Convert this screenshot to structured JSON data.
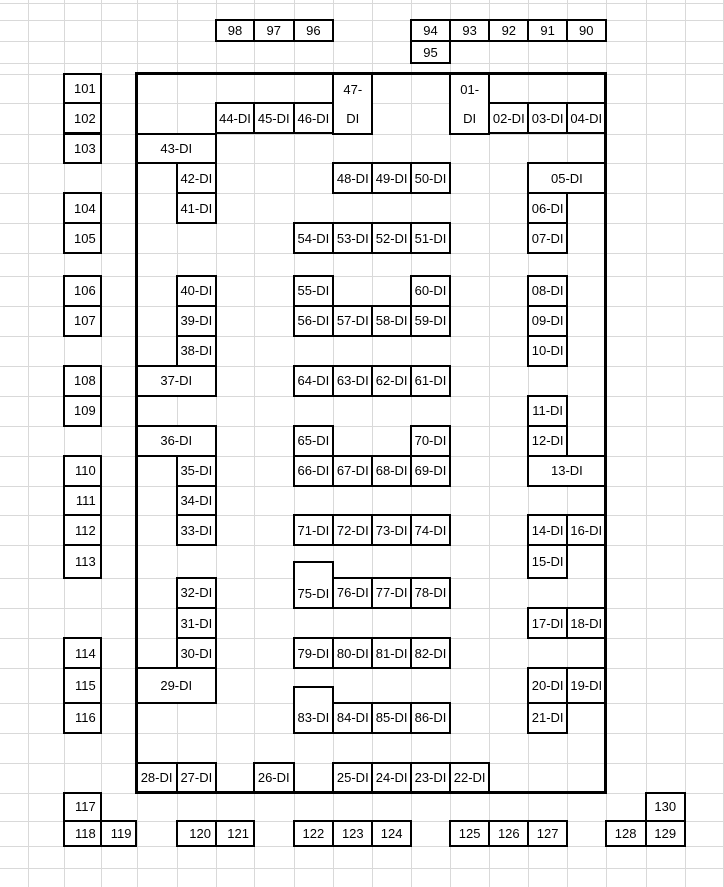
{
  "sheet": {
    "background": "#ffffff",
    "gridline_color": "#d9d9d9",
    "cell_border_color": "#000000",
    "outline_border_color": "#000000",
    "text_color": "#000000",
    "col_lines": [
      28,
      64,
      100.7,
      136.5,
      176.7,
      216,
      254,
      293.5,
      333.3,
      372.3,
      411,
      450,
      489.3,
      528.3,
      567,
      605.5,
      645.8,
      684.7,
      723.3
    ],
    "row_lines": [
      3,
      20.3,
      41,
      63,
      73.5,
      103.3,
      133.5,
      163.3,
      193,
      223.3,
      253.3,
      275.7,
      305.7,
      335.7,
      365.7,
      395.7,
      425.7,
      455.7,
      485.7,
      515.3,
      545.3,
      577.7,
      608,
      638,
      668,
      702.5,
      732.5,
      762.5,
      792.5,
      821,
      846,
      868
    ],
    "outline": {
      "x1": 136.5,
      "y1": 73.5,
      "x2": 605.5,
      "y2": 792.5
    },
    "cells": [
      [
        "98",
        216,
        20.3,
        254,
        41,
        "c"
      ],
      [
        "97",
        254,
        20.3,
        293.5,
        41,
        "c"
      ],
      [
        "96",
        293.5,
        20.3,
        333.3,
        41,
        "c"
      ],
      [
        "94",
        411,
        20.3,
        450,
        41,
        "c"
      ],
      [
        "93",
        450,
        20.3,
        489.3,
        41,
        "c"
      ],
      [
        "92",
        489.3,
        20.3,
        528.3,
        41,
        "c"
      ],
      [
        "91",
        528.3,
        20.3,
        567,
        41,
        "c"
      ],
      [
        "90",
        567,
        20.3,
        605.5,
        41,
        "c"
      ],
      [
        "95",
        411,
        41,
        450,
        63,
        "c"
      ],
      [
        "101",
        64,
        73.5,
        100.7,
        103.3,
        "r"
      ],
      [
        "102",
        64,
        103.3,
        100.7,
        133.5,
        "r"
      ],
      [
        "103",
        64,
        133.5,
        100.7,
        163.3,
        "r"
      ],
      [
        "104",
        64,
        193,
        100.7,
        223.3,
        "r"
      ],
      [
        "105",
        64,
        223.3,
        100.7,
        253.3,
        "r"
      ],
      [
        "106",
        64,
        275.7,
        100.7,
        305.7,
        "r"
      ],
      [
        "107",
        64,
        305.7,
        100.7,
        335.7,
        "r"
      ],
      [
        "108",
        64,
        365.7,
        100.7,
        395.7,
        "r"
      ],
      [
        "109",
        64,
        395.7,
        100.7,
        425.7,
        "r"
      ],
      [
        "110",
        64,
        455.7,
        100.7,
        485.7,
        "r"
      ],
      [
        "111",
        64,
        485.7,
        100.7,
        515.3,
        "r"
      ],
      [
        "112",
        64,
        515.3,
        100.7,
        545.3,
        "r"
      ],
      [
        "113",
        64,
        545.3,
        100.7,
        577.7,
        "r"
      ],
      [
        "114",
        64,
        638,
        100.7,
        668,
        "r"
      ],
      [
        "115",
        64,
        668,
        100.7,
        702.5,
        "r"
      ],
      [
        "116",
        64,
        702.5,
        100.7,
        732.5,
        "r"
      ],
      [
        "117",
        64,
        792.5,
        100.7,
        821,
        "r"
      ],
      [
        "118",
        64,
        821,
        100.7,
        846,
        "r"
      ],
      [
        "119",
        100.7,
        821,
        136.5,
        846,
        "r"
      ],
      [
        "120",
        176.7,
        821,
        216,
        846,
        "r"
      ],
      [
        "121",
        216,
        821,
        254,
        846,
        "r"
      ],
      [
        "122",
        293.5,
        821,
        333.3,
        846,
        "c"
      ],
      [
        "123",
        333.3,
        821,
        372.3,
        846,
        "c"
      ],
      [
        "124",
        372.3,
        821,
        411,
        846,
        "c"
      ],
      [
        "125",
        450,
        821,
        489.3,
        846,
        "c"
      ],
      [
        "126",
        489.3,
        821,
        528.3,
        846,
        "c"
      ],
      [
        "127",
        528.3,
        821,
        567,
        846,
        "c"
      ],
      [
        "128",
        605.5,
        821,
        645.8,
        846,
        "c"
      ],
      [
        "129",
        645.8,
        821,
        684.7,
        846,
        "c"
      ],
      [
        "130",
        645.8,
        792.5,
        684.7,
        821,
        "c"
      ],
      [
        "01-\nDI",
        450,
        73.5,
        489.3,
        133.5,
        "c"
      ],
      [
        "02-DI",
        489.3,
        103.3,
        528.3,
        133.5,
        "c"
      ],
      [
        "03-DI",
        528.3,
        103.3,
        567,
        133.5,
        "c"
      ],
      [
        "04-DI",
        567,
        103.3,
        605.5,
        133.5,
        "c"
      ],
      [
        "05-DI",
        528.3,
        163.3,
        605.5,
        193,
        "c"
      ],
      [
        "06-DI",
        528.3,
        193,
        567,
        223.3,
        "c"
      ],
      [
        "07-DI",
        528.3,
        223.3,
        567,
        253.3,
        "c"
      ],
      [
        "08-DI",
        528.3,
        275.7,
        567,
        305.7,
        "c"
      ],
      [
        "09-DI",
        528.3,
        305.7,
        567,
        335.7,
        "c"
      ],
      [
        "10-DI",
        528.3,
        335.7,
        567,
        365.7,
        "c"
      ],
      [
        "11-DI",
        528.3,
        395.7,
        567,
        425.7,
        "c"
      ],
      [
        "12-DI",
        528.3,
        425.7,
        567,
        455.7,
        "c"
      ],
      [
        "13-DI",
        528.3,
        455.7,
        605.5,
        485.7,
        "c"
      ],
      [
        "14-DI",
        528.3,
        515.3,
        567,
        545.3,
        "c"
      ],
      [
        "15-DI",
        528.3,
        545.3,
        567,
        577.7,
        "c"
      ],
      [
        "16-DI",
        567,
        515.3,
        605.5,
        545.3,
        "c"
      ],
      [
        "17-DI",
        528.3,
        608,
        567,
        638,
        "c"
      ],
      [
        "18-DI",
        567,
        608,
        605.5,
        638,
        "c"
      ],
      [
        "19-DI",
        567,
        668,
        605.5,
        702.5,
        "c"
      ],
      [
        "20-DI",
        528.3,
        668,
        567,
        702.5,
        "c"
      ],
      [
        "21-DI",
        528.3,
        702.5,
        567,
        732.5,
        "c"
      ],
      [
        "22-DI",
        450,
        762.5,
        489.3,
        792.5,
        "c"
      ],
      [
        "23-DI",
        411,
        762.5,
        450,
        792.5,
        "c"
      ],
      [
        "24-DI",
        372.3,
        762.5,
        411,
        792.5,
        "c"
      ],
      [
        "25-DI",
        333.3,
        762.5,
        372.3,
        792.5,
        "c"
      ],
      [
        "26-DI",
        254,
        762.5,
        293.5,
        792.5,
        "c"
      ],
      [
        "27-DI",
        176.7,
        762.5,
        216,
        792.5,
        "c"
      ],
      [
        "28-DI",
        136.5,
        762.5,
        176.7,
        792.5,
        "c"
      ],
      [
        "29-DI",
        136.5,
        668,
        216,
        702.5,
        "c"
      ],
      [
        "30-DI",
        176.7,
        638,
        216,
        668,
        "c"
      ],
      [
        "31-DI",
        176.7,
        608,
        216,
        638,
        "c"
      ],
      [
        "32-DI",
        176.7,
        577.7,
        216,
        608,
        "c"
      ],
      [
        "33-DI",
        176.7,
        515.3,
        216,
        545.3,
        "c"
      ],
      [
        "34-DI",
        176.7,
        485.7,
        216,
        515.3,
        "c"
      ],
      [
        "35-DI",
        176.7,
        455.7,
        216,
        485.7,
        "c"
      ],
      [
        "36-DI",
        136.5,
        425.7,
        216,
        455.7,
        "c"
      ],
      [
        "37-DI",
        136.5,
        365.7,
        216,
        395.7,
        "c"
      ],
      [
        "38-DI",
        176.7,
        335.7,
        216,
        365.7,
        "c"
      ],
      [
        "39-DI",
        176.7,
        305.7,
        216,
        335.7,
        "c"
      ],
      [
        "40-DI",
        176.7,
        275.7,
        216,
        305.7,
        "c"
      ],
      [
        "41-DI",
        176.7,
        193,
        216,
        223.3,
        "c"
      ],
      [
        "42-DI",
        176.7,
        163.3,
        216,
        193,
        "c"
      ],
      [
        "43-DI",
        136.5,
        133.5,
        216,
        163.3,
        "c"
      ],
      [
        "44-DI",
        216,
        103.3,
        254,
        133.5,
        "c"
      ],
      [
        "45-DI",
        254,
        103.3,
        293.5,
        133.5,
        "c"
      ],
      [
        "46-DI",
        293.5,
        103.3,
        333.3,
        133.5,
        "c"
      ],
      [
        "47-\nDI",
        333.3,
        73.5,
        372.3,
        133.5,
        "c"
      ],
      [
        "48-DI",
        333.3,
        163.3,
        372.3,
        193,
        "c"
      ],
      [
        "49-DI",
        372.3,
        163.3,
        411,
        193,
        "c"
      ],
      [
        "50-DI",
        411,
        163.3,
        450,
        193,
        "c"
      ],
      [
        "51-DI",
        411,
        223.3,
        450,
        253.3,
        "c"
      ],
      [
        "52-DI",
        372.3,
        223.3,
        411,
        253.3,
        "c"
      ],
      [
        "53-DI",
        333.3,
        223.3,
        372.3,
        253.3,
        "c"
      ],
      [
        "54-DI",
        293.5,
        223.3,
        333.3,
        253.3,
        "c"
      ],
      [
        "55-DI",
        293.5,
        275.7,
        333.3,
        305.7,
        "c"
      ],
      [
        "56-DI",
        293.5,
        305.7,
        333.3,
        335.7,
        "c"
      ],
      [
        "57-DI",
        333.3,
        305.7,
        372.3,
        335.7,
        "c"
      ],
      [
        "58-DI",
        372.3,
        305.7,
        411,
        335.7,
        "c"
      ],
      [
        "59-DI",
        411,
        305.7,
        450,
        335.7,
        "c"
      ],
      [
        "60-DI",
        411,
        275.7,
        450,
        305.7,
        "c"
      ],
      [
        "61-DI",
        411,
        365.7,
        450,
        395.7,
        "c"
      ],
      [
        "62-DI",
        372.3,
        365.7,
        411,
        395.7,
        "c"
      ],
      [
        "63-DI",
        333.3,
        365.7,
        372.3,
        395.7,
        "c"
      ],
      [
        "64-DI",
        293.5,
        365.7,
        333.3,
        395.7,
        "c"
      ],
      [
        "65-DI",
        293.5,
        425.7,
        333.3,
        455.7,
        "c"
      ],
      [
        "66-DI",
        293.5,
        455.7,
        333.3,
        485.7,
        "c"
      ],
      [
        "67-DI",
        333.3,
        455.7,
        372.3,
        485.7,
        "c"
      ],
      [
        "68-DI",
        372.3,
        455.7,
        411,
        485.7,
        "c"
      ],
      [
        "69-DI",
        411,
        455.7,
        450,
        485.7,
        "c"
      ],
      [
        "70-DI",
        411,
        425.7,
        450,
        455.7,
        "c"
      ],
      [
        "71-DI",
        293.5,
        515.3,
        333.3,
        545.3,
        "c"
      ],
      [
        "72-DI",
        333.3,
        515.3,
        372.3,
        545.3,
        "c"
      ],
      [
        "73-DI",
        372.3,
        515.3,
        411,
        545.3,
        "c"
      ],
      [
        "74-DI",
        411,
        515.3,
        450,
        545.3,
        "c"
      ],
      [
        "75-DI",
        293.5,
        562,
        333.3,
        608,
        "c",
        16
      ],
      [
        "76-DI",
        333.3,
        577.7,
        372.3,
        608,
        "c"
      ],
      [
        "77-DI",
        372.3,
        577.7,
        411,
        608,
        "c"
      ],
      [
        "78-DI",
        411,
        577.7,
        450,
        608,
        "c"
      ],
      [
        "79-DI",
        293.5,
        638,
        333.3,
        668,
        "c"
      ],
      [
        "80-DI",
        333.3,
        638,
        372.3,
        668,
        "c"
      ],
      [
        "81-DI",
        372.3,
        638,
        411,
        668,
        "c"
      ],
      [
        "82-DI",
        411,
        638,
        450,
        668,
        "c"
      ],
      [
        "83-DI",
        293.5,
        687,
        333.3,
        732.5,
        "c",
        15
      ],
      [
        "84-DI",
        333.3,
        702.5,
        372.3,
        732.5,
        "c"
      ],
      [
        "85-DI",
        372.3,
        702.5,
        411,
        732.5,
        "c"
      ],
      [
        "86-DI",
        411,
        702.5,
        450,
        732.5,
        "c"
      ]
    ]
  }
}
